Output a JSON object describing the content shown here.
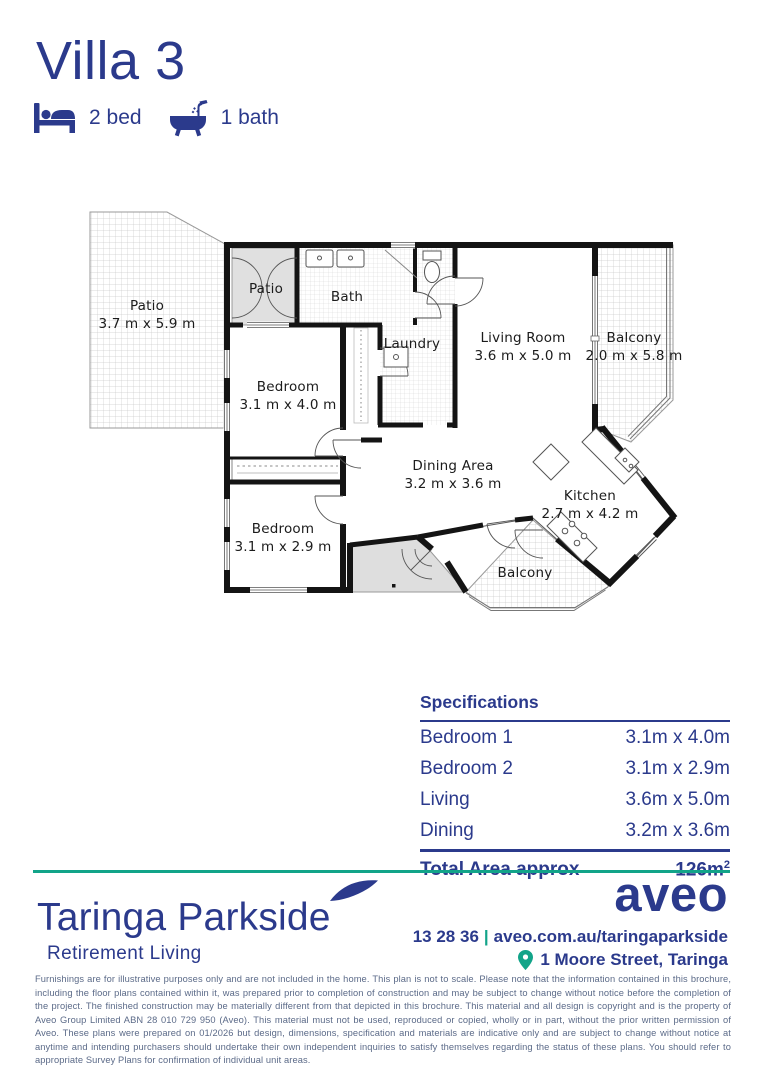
{
  "header": {
    "title": "Villa 3",
    "features": [
      {
        "icon": "bed-icon",
        "label": "2 bed"
      },
      {
        "icon": "bath-icon",
        "label": "1 bath"
      }
    ]
  },
  "floorplan": {
    "rooms": [
      {
        "id": "patio-large",
        "name": "Patio",
        "dims": "3.7 m x 5.9 m"
      },
      {
        "id": "patio-small",
        "name": "Patio",
        "dims": ""
      },
      {
        "id": "bath",
        "name": "Bath",
        "dims": ""
      },
      {
        "id": "laundry",
        "name": "Laundry",
        "dims": ""
      },
      {
        "id": "living",
        "name": "Living Room",
        "dims": "3.6 m x 5.0 m"
      },
      {
        "id": "balcony-right",
        "name": "Balcony",
        "dims": "2.0 m x 5.8 m"
      },
      {
        "id": "bedroom-1",
        "name": "Bedroom",
        "dims": "3.1 m x 4.0 m"
      },
      {
        "id": "dining",
        "name": "Dining Area",
        "dims": "3.2 m x 3.6 m"
      },
      {
        "id": "kitchen",
        "name": "Kitchen",
        "dims": "2.7 m x 4.2 m"
      },
      {
        "id": "bedroom-2",
        "name": "Bedroom",
        "dims": "3.1 m x 2.9 m"
      },
      {
        "id": "balcony-bottom",
        "name": "Balcony",
        "dims": ""
      }
    ]
  },
  "specifications": {
    "title": "Specifications",
    "rows": [
      {
        "label": "Bedroom 1",
        "value": "3.1m x 4.0m"
      },
      {
        "label": "Bedroom 2",
        "value": "3.1m x 2.9m"
      },
      {
        "label": "Living",
        "value": "3.6m x 5.0m"
      },
      {
        "label": "Dining",
        "value": "3.2m x 3.6m"
      }
    ],
    "total": {
      "label": "Total Area approx",
      "value": "126m",
      "sup": "2"
    }
  },
  "footer": {
    "community": "Taringa Parkside",
    "tagline": "Retirement Living",
    "brand": "aveo",
    "phone": "13 28 36",
    "separator": "|",
    "website": "aveo.com.au/taringaparkside",
    "address": "1 Moore Street, Taringa"
  },
  "disclaimer": "Furnishings are for illustrative purposes only and are not included in the home. This plan is not to scale. Please note that the information contained in this brochure, including the floor plans contained within it, was prepared prior to completion of construction and may be subject to change without notice before the completion of the project. The finished construction may be materially different from that depicted in this brochure. This material and all design is copyright and is the property of Aveo Group Limited ABN 28 010 729 950 (Aveo). This material must not be used, reproduced or copied, wholly or in part, without the prior written permission of Aveo. These plans were prepared on 01/2026 but design, dimensions, specification and materials are indicative only and are subject to change without notice at anytime and intending purchasers should undertake their own independent inquiries to satisfy themselves regarding the status of these plans. You should refer to appropriate Survey Plans for confirmation of individual unit areas.",
  "colors": {
    "navy": "#2B3A8C",
    "teal": "#12A489",
    "muted": "#5B6A88"
  }
}
